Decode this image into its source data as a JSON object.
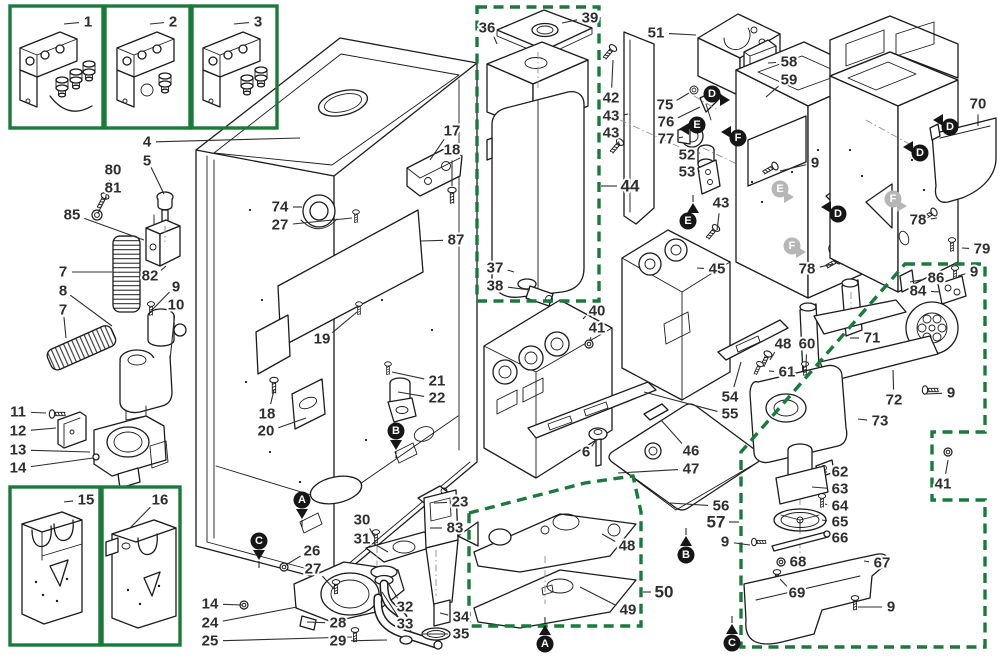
{
  "figure": {
    "type": "exploded-parts-diagram"
  },
  "colors": {
    "line": "#1b1b1b",
    "label": "#2e2e2e",
    "green": "#1a7a3c",
    "gray_marker": "#b6b6b6",
    "background": "#ffffff"
  },
  "inset_boxes": [
    {
      "name": "detail-box-1",
      "x": 10,
      "y": 6,
      "w": 93,
      "h": 122
    },
    {
      "name": "detail-box-2",
      "x": 105,
      "y": 6,
      "w": 85,
      "h": 122
    },
    {
      "name": "detail-box-3",
      "x": 192,
      "y": 6,
      "w": 85,
      "h": 122
    },
    {
      "name": "detail-box-15",
      "x": 10,
      "y": 487,
      "w": 90,
      "h": 158
    },
    {
      "name": "detail-box-16",
      "x": 102,
      "y": 487,
      "w": 78,
      "h": 158
    }
  ],
  "dashed_boxes": [
    {
      "name": "assembly-box-44-water-tank",
      "points": [
        [
          477,
          7
        ],
        [
          599,
          7
        ],
        [
          599,
          301
        ],
        [
          477,
          301
        ]
      ]
    },
    {
      "name": "assembly-box-50-plates",
      "points": [
        [
          469,
          513
        ],
        [
          585,
          483
        ],
        [
          633,
          476
        ],
        [
          641,
          512
        ],
        [
          641,
          626
        ],
        [
          469,
          626
        ]
      ]
    },
    {
      "name": "assembly-box-57-grinder",
      "points": [
        [
          905,
          264
        ],
        [
          985,
          264
        ],
        [
          985,
          432
        ],
        [
          932,
          432
        ],
        [
          932,
          500
        ],
        [
          985,
          500
        ],
        [
          985,
          647
        ],
        [
          741,
          647
        ],
        [
          741,
          452
        ]
      ]
    }
  ],
  "part_labels": [
    {
      "t": "1",
      "x": 88,
      "y": 22,
      "lx": 64,
      "ly": 24
    },
    {
      "t": "2",
      "x": 173,
      "y": 22,
      "lx": 150,
      "ly": 24
    },
    {
      "t": "3",
      "x": 258,
      "y": 22,
      "lx": 234,
      "ly": 24
    },
    {
      "t": "4",
      "x": 147,
      "y": 142,
      "lx": 300,
      "ly": 138
    },
    {
      "t": "5",
      "x": 147,
      "y": 161,
      "lx": 164,
      "ly": 194
    },
    {
      "t": "80",
      "x": 113,
      "y": 170,
      "lx": 105,
      "ly": 200
    },
    {
      "t": "81",
      "x": 113,
      "y": 188,
      "lx": 98,
      "ly": 213
    },
    {
      "t": "85",
      "x": 72,
      "y": 215,
      "lx": 144,
      "ly": 240
    },
    {
      "t": "82",
      "x": 150,
      "y": 276,
      "lx": 166,
      "ly": 266
    },
    {
      "t": "7",
      "x": 63,
      "y": 272,
      "lx": 112,
      "ly": 272
    },
    {
      "t": "8",
      "x": 63,
      "y": 291,
      "lx": 112,
      "ly": 326
    },
    {
      "t": "7",
      "x": 63,
      "y": 310,
      "lx": 66,
      "ly": 338
    },
    {
      "t": "9",
      "x": 176,
      "y": 287,
      "lx": 152,
      "ly": 310
    },
    {
      "t": "10",
      "x": 176,
      "y": 305,
      "lx": 170,
      "ly": 360
    },
    {
      "t": "11",
      "x": 18,
      "y": 412,
      "lx": 46,
      "ly": 413
    },
    {
      "t": "12",
      "x": 18,
      "y": 431,
      "lx": 56,
      "ly": 428
    },
    {
      "t": "13",
      "x": 18,
      "y": 450,
      "lx": 90,
      "ly": 452
    },
    {
      "t": "14",
      "x": 18,
      "y": 468,
      "lx": 93,
      "ly": 458
    },
    {
      "t": "15",
      "x": 86,
      "y": 500,
      "lx": 64,
      "ly": 502
    },
    {
      "t": "16",
      "x": 160,
      "y": 500,
      "lx": 130,
      "ly": 528
    },
    {
      "t": "17",
      "x": 452,
      "y": 131,
      "lx": 430,
      "ly": 160
    },
    {
      "t": "18",
      "x": 452,
      "y": 150,
      "lx": 452,
      "ly": 186
    },
    {
      "t": "74",
      "x": 280,
      "y": 207,
      "lx": 302,
      "ly": 207
    },
    {
      "t": "27",
      "x": 280,
      "y": 225,
      "lx": 352,
      "ly": 218
    },
    {
      "t": "87",
      "x": 456,
      "y": 240,
      "lx": 421,
      "ly": 241
    },
    {
      "t": "19",
      "x": 322,
      "y": 339,
      "lx": 357,
      "ly": 312
    },
    {
      "t": "21",
      "x": 437,
      "y": 381,
      "lx": 392,
      "ly": 372
    },
    {
      "t": "22",
      "x": 437,
      "y": 398,
      "lx": 398,
      "ly": 392
    },
    {
      "t": "18",
      "x": 267,
      "y": 414,
      "lx": 274,
      "ly": 390
    },
    {
      "t": "20",
      "x": 266,
      "y": 431,
      "lx": 306,
      "ly": 418
    },
    {
      "t": "26",
      "x": 312,
      "y": 551,
      "lx": 286,
      "ly": 565
    },
    {
      "t": "27",
      "x": 313,
      "y": 569,
      "lx": 334,
      "ly": 589
    },
    {
      "t": "30",
      "x": 362,
      "y": 520,
      "lx": 375,
      "ly": 538
    },
    {
      "t": "31",
      "x": 362,
      "y": 539,
      "lx": 388,
      "ly": 552
    },
    {
      "t": "14",
      "x": 210,
      "y": 604,
      "lx": 242,
      "ly": 605
    },
    {
      "t": "24",
      "x": 210,
      "y": 623,
      "lx": 297,
      "ly": 607
    },
    {
      "t": "25",
      "x": 210,
      "y": 641,
      "lx": 352,
      "ly": 637
    },
    {
      "t": "28",
      "x": 338,
      "y": 623,
      "lx": 307,
      "ly": 622
    },
    {
      "t": "29",
      "x": 338,
      "y": 641,
      "lx": 387,
      "ly": 640
    },
    {
      "t": "32",
      "x": 405,
      "y": 607,
      "lx": 387,
      "ly": 581
    },
    {
      "t": "33",
      "x": 405,
      "y": 624,
      "lx": 382,
      "ly": 592
    },
    {
      "t": "34",
      "x": 461,
      "y": 617,
      "lx": 440,
      "ly": 613
    },
    {
      "t": "35",
      "x": 461,
      "y": 634,
      "lx": 423,
      "ly": 634
    },
    {
      "t": "23",
      "x": 460,
      "y": 502,
      "lx": 434,
      "ly": 503
    },
    {
      "t": "83",
      "x": 455,
      "y": 528,
      "lx": 430,
      "ly": 528
    },
    {
      "t": "36",
      "x": 487,
      "y": 28,
      "lx": 497,
      "ly": 44
    },
    {
      "t": "39",
      "x": 590,
      "y": 18,
      "lx": 562,
      "ly": 23
    },
    {
      "t": "37",
      "x": 495,
      "y": 268,
      "lx": 514,
      "ly": 272
    },
    {
      "t": "38",
      "x": 495,
      "y": 286,
      "lx": 530,
      "ly": 290
    },
    {
      "t": "42",
      "x": 611,
      "y": 98,
      "lx": 613,
      "ly": 60
    },
    {
      "t": "43",
      "x": 611,
      "y": 116,
      "lx": 628,
      "ly": 114
    },
    {
      "t": "43",
      "x": 611,
      "y": 133,
      "lx": 620,
      "ly": 146
    },
    {
      "t": "44",
      "x": 630,
      "y": 186,
      "lx": 601,
      "ly": 186,
      "b": 1
    },
    {
      "t": "40",
      "x": 597,
      "y": 311,
      "lx": 583,
      "ly": 319
    },
    {
      "t": "41",
      "x": 597,
      "y": 328,
      "lx": 590,
      "ly": 341
    },
    {
      "t": "51",
      "x": 656,
      "y": 33,
      "lx": 696,
      "ly": 35
    },
    {
      "t": "58",
      "x": 789,
      "y": 62,
      "lx": 768,
      "ly": 63
    },
    {
      "t": "59",
      "x": 789,
      "y": 80,
      "lx": 766,
      "ly": 97
    },
    {
      "t": "75",
      "x": 665,
      "y": 105,
      "lx": 689,
      "ly": 93
    },
    {
      "t": "76",
      "x": 666,
      "y": 122,
      "lx": 700,
      "ly": 107
    },
    {
      "t": "77",
      "x": 666,
      "y": 139,
      "lx": 683,
      "ly": 137
    },
    {
      "t": "52",
      "x": 687,
      "y": 155,
      "lx": 699,
      "ly": 153
    },
    {
      "t": "53",
      "x": 687,
      "y": 172,
      "lx": 699,
      "ly": 171
    },
    {
      "t": "43",
      "x": 721,
      "y": 203,
      "lx": 717,
      "ly": 230
    },
    {
      "t": "9",
      "x": 815,
      "y": 163,
      "lx": 780,
      "ly": 171
    },
    {
      "t": "70",
      "x": 978,
      "y": 104,
      "lx": 978,
      "ly": 126
    },
    {
      "t": "78",
      "x": 918,
      "y": 220,
      "lx": 937,
      "ly": 218
    },
    {
      "t": "79",
      "x": 982,
      "y": 249,
      "lx": 962,
      "ly": 248
    },
    {
      "t": "78",
      "x": 807,
      "y": 269,
      "lx": 833,
      "ly": 264
    },
    {
      "t": "45",
      "x": 717,
      "y": 269,
      "lx": 697,
      "ly": 268
    },
    {
      "t": "86",
      "x": 936,
      "y": 278,
      "lx": 910,
      "ly": 282
    },
    {
      "t": "84",
      "x": 918,
      "y": 291,
      "lx": 940,
      "ly": 292
    },
    {
      "t": "9",
      "x": 974,
      "y": 272,
      "lx": 958,
      "ly": 276
    },
    {
      "t": "54",
      "x": 730,
      "y": 397,
      "lx": 741,
      "ly": 362
    },
    {
      "t": "55",
      "x": 730,
      "y": 414,
      "lx": 644,
      "ly": 392
    },
    {
      "t": "46",
      "x": 691,
      "y": 451,
      "lx": 661,
      "ly": 420
    },
    {
      "t": "47",
      "x": 691,
      "y": 469,
      "lx": 618,
      "ly": 473
    },
    {
      "t": "6",
      "x": 586,
      "y": 452,
      "lx": 596,
      "ly": 440
    },
    {
      "t": "56",
      "x": 721,
      "y": 506,
      "lx": 670,
      "ly": 503
    },
    {
      "t": "57",
      "x": 716,
      "y": 522,
      "lx": 739,
      "ly": 522,
      "b": 1
    },
    {
      "t": "9",
      "x": 725,
      "y": 542,
      "lx": 750,
      "ly": 545
    },
    {
      "t": "48",
      "x": 627,
      "y": 546,
      "lx": 602,
      "ly": 534
    },
    {
      "t": "49",
      "x": 628,
      "y": 610,
      "lx": 580,
      "ly": 587
    },
    {
      "t": "50",
      "x": 664,
      "y": 592,
      "lx": 643,
      "ly": 592,
      "b": 1
    },
    {
      "t": "48",
      "x": 783,
      "y": 344,
      "lx": 770,
      "ly": 360
    },
    {
      "t": "60",
      "x": 807,
      "y": 344,
      "lx": 806,
      "ly": 366
    },
    {
      "t": "61",
      "x": 787,
      "y": 372,
      "lx": 769,
      "ly": 371
    },
    {
      "t": "71",
      "x": 872,
      "y": 338,
      "lx": 850,
      "ly": 338
    },
    {
      "t": "72",
      "x": 894,
      "y": 400,
      "lx": 893,
      "ly": 370
    },
    {
      "t": "73",
      "x": 880,
      "y": 421,
      "lx": 858,
      "ly": 419
    },
    {
      "t": "9",
      "x": 951,
      "y": 393,
      "lx": 925,
      "ly": 394
    },
    {
      "t": "62",
      "x": 840,
      "y": 472,
      "lx": 824,
      "ly": 472
    },
    {
      "t": "63",
      "x": 840,
      "y": 489,
      "lx": 812,
      "ly": 487
    },
    {
      "t": "64",
      "x": 840,
      "y": 506,
      "lx": 825,
      "ly": 504
    },
    {
      "t": "65",
      "x": 840,
      "y": 522,
      "lx": 822,
      "ly": 520
    },
    {
      "t": "66",
      "x": 840,
      "y": 538,
      "lx": 825,
      "ly": 537
    },
    {
      "t": "68",
      "x": 798,
      "y": 562,
      "lx": 786,
      "ly": 562
    },
    {
      "t": "69",
      "x": 797,
      "y": 593,
      "lx": 780,
      "ly": 579
    },
    {
      "t": "67",
      "x": 882,
      "y": 563,
      "lx": 864,
      "ly": 561
    },
    {
      "t": "9",
      "x": 891,
      "y": 607,
      "lx": 858,
      "ly": 607
    },
    {
      "t": "41",
      "x": 943,
      "y": 484,
      "lx": 948,
      "ly": 460
    }
  ],
  "ref_markers": [
    {
      "l": "A",
      "x": 302,
      "y": 500,
      "tx": 302,
      "ty": 513,
      "dir": "down"
    },
    {
      "l": "B",
      "x": 396,
      "y": 431,
      "tx": 396,
      "ty": 444,
      "dir": "down"
    },
    {
      "l": "C",
      "x": 259,
      "y": 541,
      "tx": 259,
      "ty": 554,
      "dir": "down"
    },
    {
      "l": "A",
      "x": 545,
      "y": 644,
      "tx": 545,
      "ty": 631,
      "dir": "up"
    },
    {
      "l": "B",
      "x": 686,
      "y": 555,
      "tx": 686,
      "ty": 542,
      "dir": "up"
    },
    {
      "l": "C",
      "x": 732,
      "y": 643,
      "tx": 732,
      "ty": 630,
      "dir": "up"
    },
    {
      "l": "D",
      "x": 712,
      "y": 94,
      "tx": 724,
      "ty": 100,
      "dir": "right"
    },
    {
      "l": "E",
      "x": 697,
      "y": 125,
      "tx": 685,
      "ty": 129,
      "dir": "left"
    },
    {
      "l": "F",
      "x": 738,
      "y": 138,
      "tx": 727,
      "ty": 132,
      "dir": "left"
    },
    {
      "l": "E",
      "x": 688,
      "y": 221,
      "tx": 693,
      "ty": 209,
      "dir": "up"
    },
    {
      "l": "D",
      "x": 950,
      "y": 127,
      "tx": 939,
      "ty": 120,
      "dir": "left"
    },
    {
      "l": "D",
      "x": 920,
      "y": 153,
      "tx": 909,
      "ty": 147,
      "dir": "left"
    },
    {
      "l": "D",
      "x": 838,
      "y": 214,
      "tx": 827,
      "ty": 207,
      "dir": "left"
    },
    {
      "l": "E",
      "x": 780,
      "y": 189,
      "tx": 788,
      "ty": 197,
      "dir": "right",
      "gray": true
    },
    {
      "l": "F",
      "x": 893,
      "y": 199,
      "tx": 901,
      "ty": 206,
      "dir": "right",
      "gray": true
    },
    {
      "l": "F",
      "x": 792,
      "y": 246,
      "tx": 800,
      "ty": 252,
      "dir": "right",
      "gray": true
    }
  ]
}
